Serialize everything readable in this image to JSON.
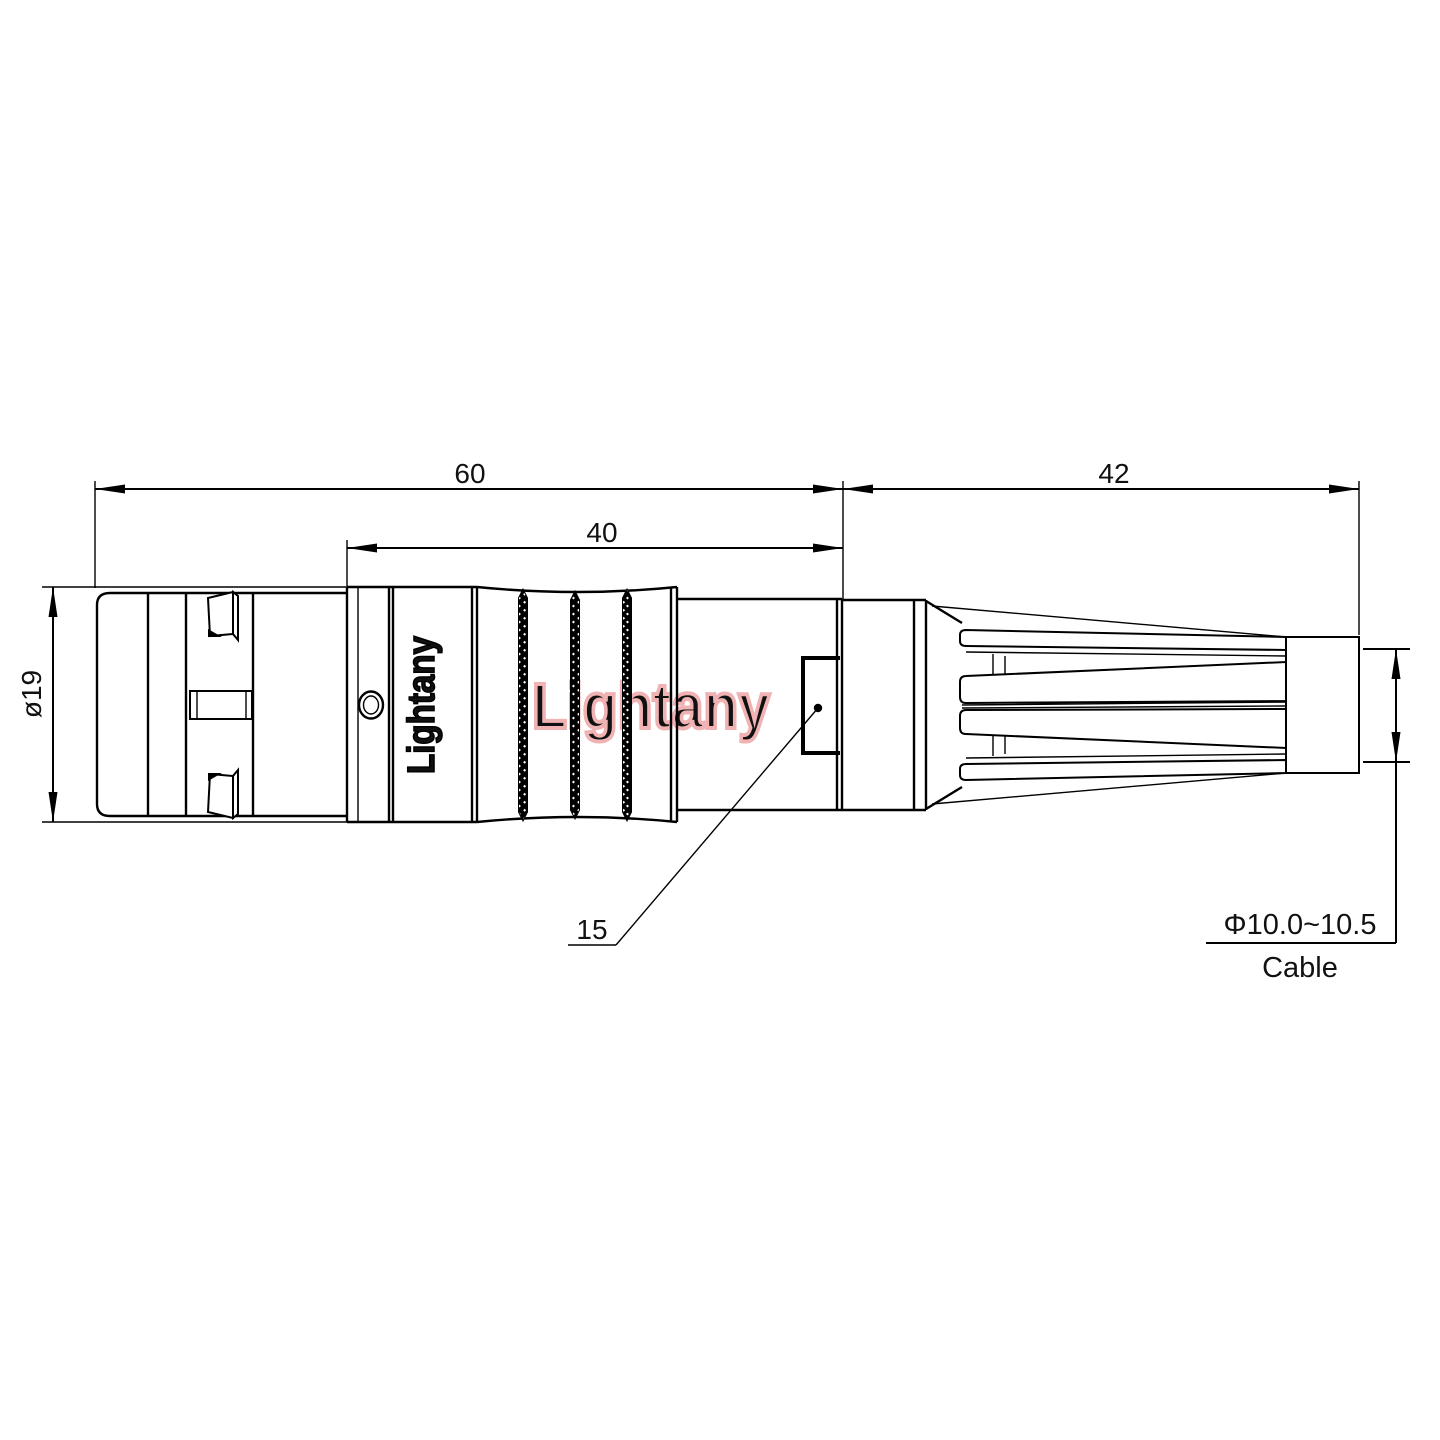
{
  "drawing": {
    "type": "connector-outline-dimension-drawing",
    "dimensions": {
      "overall_length": "60",
      "rear_section_length": "40",
      "boot_length": "42",
      "shell_diameter": "ø19",
      "latch_reference": "15",
      "cable_diameter_range": "Φ10.0~10.5",
      "cable_word": "Cable"
    },
    "brand": {
      "engraved_text": "Lightany",
      "watermark_text": "Lightany"
    },
    "colors": {
      "line": "#000000",
      "watermark_pink": "#f0b2b2",
      "background": "#ffffff"
    }
  }
}
